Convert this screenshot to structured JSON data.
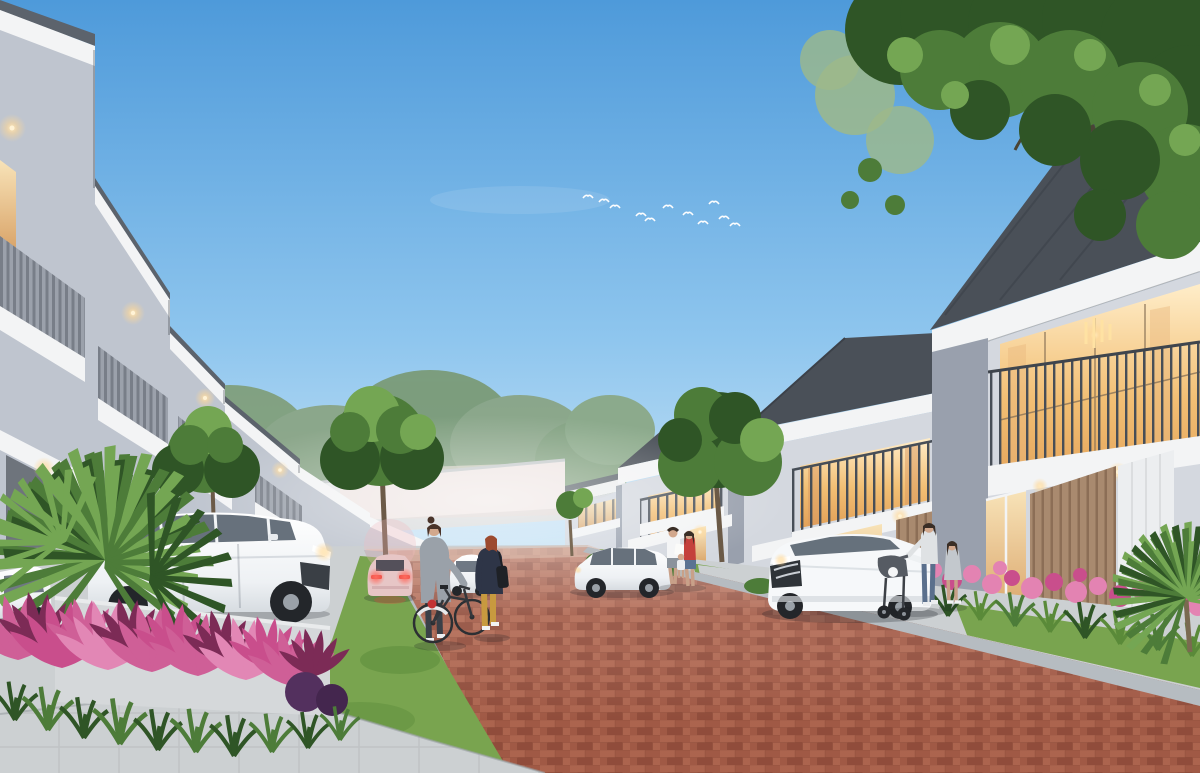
{
  "meta": {
    "type": "architectural-exterior-render",
    "alt": "Dusk render of a modern two-storey row-house street: red brick road flanked by grey houses with warm lit windows, parked white SUVs, a departing pink car, two women walking a bicycle, a family by a doorway, a mother with a stroller and child, pink cordyline planting and palms in the foreground, birds in a blue sky and a tree canopy overhanging top right.",
    "width": 1200,
    "height": 773
  },
  "palette": {
    "sky_top": "#4e9ada",
    "sky_mid": "#8fc6ee",
    "sky_horizon": "#ddeef8",
    "roof_dark": "#4a5058",
    "roof_mid": "#5c636c",
    "fascia_white": "#f3f4f5",
    "wall_light": "#d4d8df",
    "wall_mid": "#bfc5cf",
    "wall_shadow": "#a7adb9",
    "pilaster": "#99a0ad",
    "railing": "#474e57",
    "window_warm": "#f2bf74",
    "window_warm_light": "#ffedc9",
    "glass_dark": "#57626e",
    "wood_accent": "#a98a6f",
    "wood_dark": "#8c6e56",
    "road_brick": "#a55d49",
    "road_brick_light": "#b26a54",
    "road_brick_dark": "#934f3e",
    "curb_gray": "#b6bcc1",
    "sidewalk": "#ccd0d2",
    "sidewalk_dark": "#b0b5b8",
    "grass": "#79a44f",
    "grass_dark": "#5a8a39",
    "foliage": "#4d7c39",
    "foliage_light": "#74a653",
    "foliage_dark": "#2f5526",
    "flower_pink": "#e383b2",
    "flower_magenta": "#c94e8c",
    "cordyline_pink": "#cf5f97",
    "cordyline_deep": "#7c2b56",
    "wall_distant": "#e7e9ea",
    "car_white": "#f3f5f7",
    "taillight_red": "#e64840",
    "skin": "#d2a88d"
  },
  "scene": {
    "sky": {
      "bird_count": 11,
      "clouds": "faint"
    },
    "left_house_row_units": 6,
    "right_house_row_units": 4,
    "road": {
      "surface": "red-brick-pavers",
      "edges": "concrete-curbs"
    },
    "vehicles": [
      "white-suv-foreground-left",
      "white-car-far-left",
      "white-hatchback-mid-left",
      "pink-car-departing",
      "white-suv-right-driveway",
      "white-suv-carport"
    ],
    "people": [
      "woman-pushing-bicycle",
      "woman-yellow-trousers",
      "man-white-shirt",
      "woman-red-top",
      "small-child",
      "mother-with-stroller",
      "girl-grey-dress"
    ],
    "landscape": [
      "pink-cordyline-planter",
      "fan-palms",
      "street-trees",
      "overhanging-tree-canopy",
      "pink-flower-bed",
      "lawn-strips",
      "distant-treeline",
      "white-perimeter-wall"
    ]
  }
}
